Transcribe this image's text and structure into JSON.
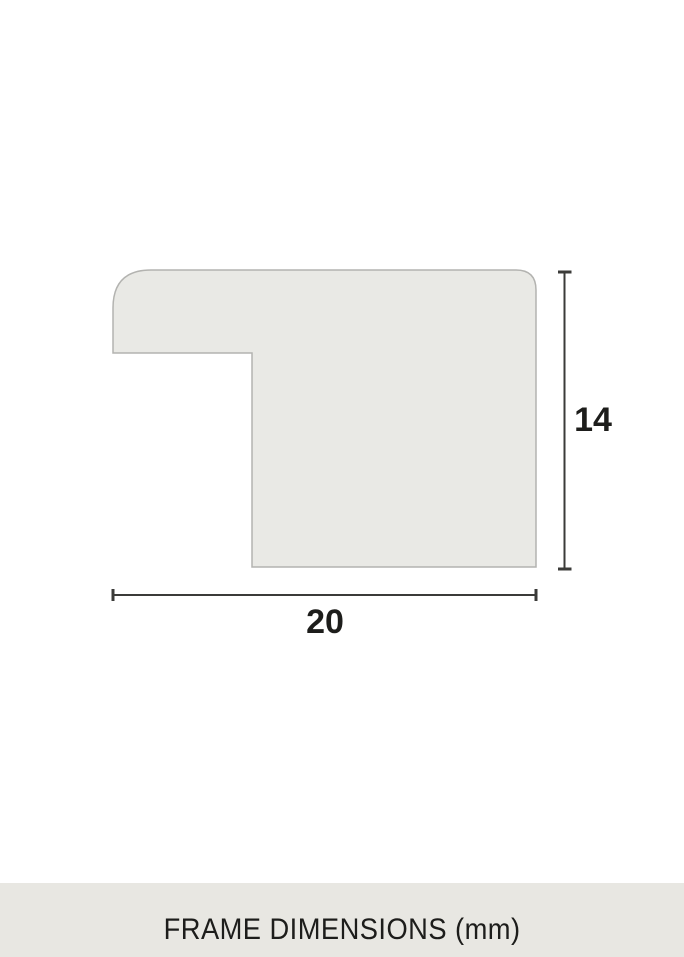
{
  "diagram": {
    "type": "frame-moulding-profile-cross-section",
    "width_label": "20",
    "height_label": "14",
    "unit": "mm",
    "colors": {
      "shape_fill": "#e9e9e5",
      "shape_border": "#b3b3b0",
      "dimension_line": "#3b3b39",
      "label_text": "#1d1d1b"
    }
  },
  "caption": {
    "text": "FRAME DIMENSIONS (mm)",
    "background": "#e8e7e2",
    "text_color": "#1d1d1b"
  }
}
